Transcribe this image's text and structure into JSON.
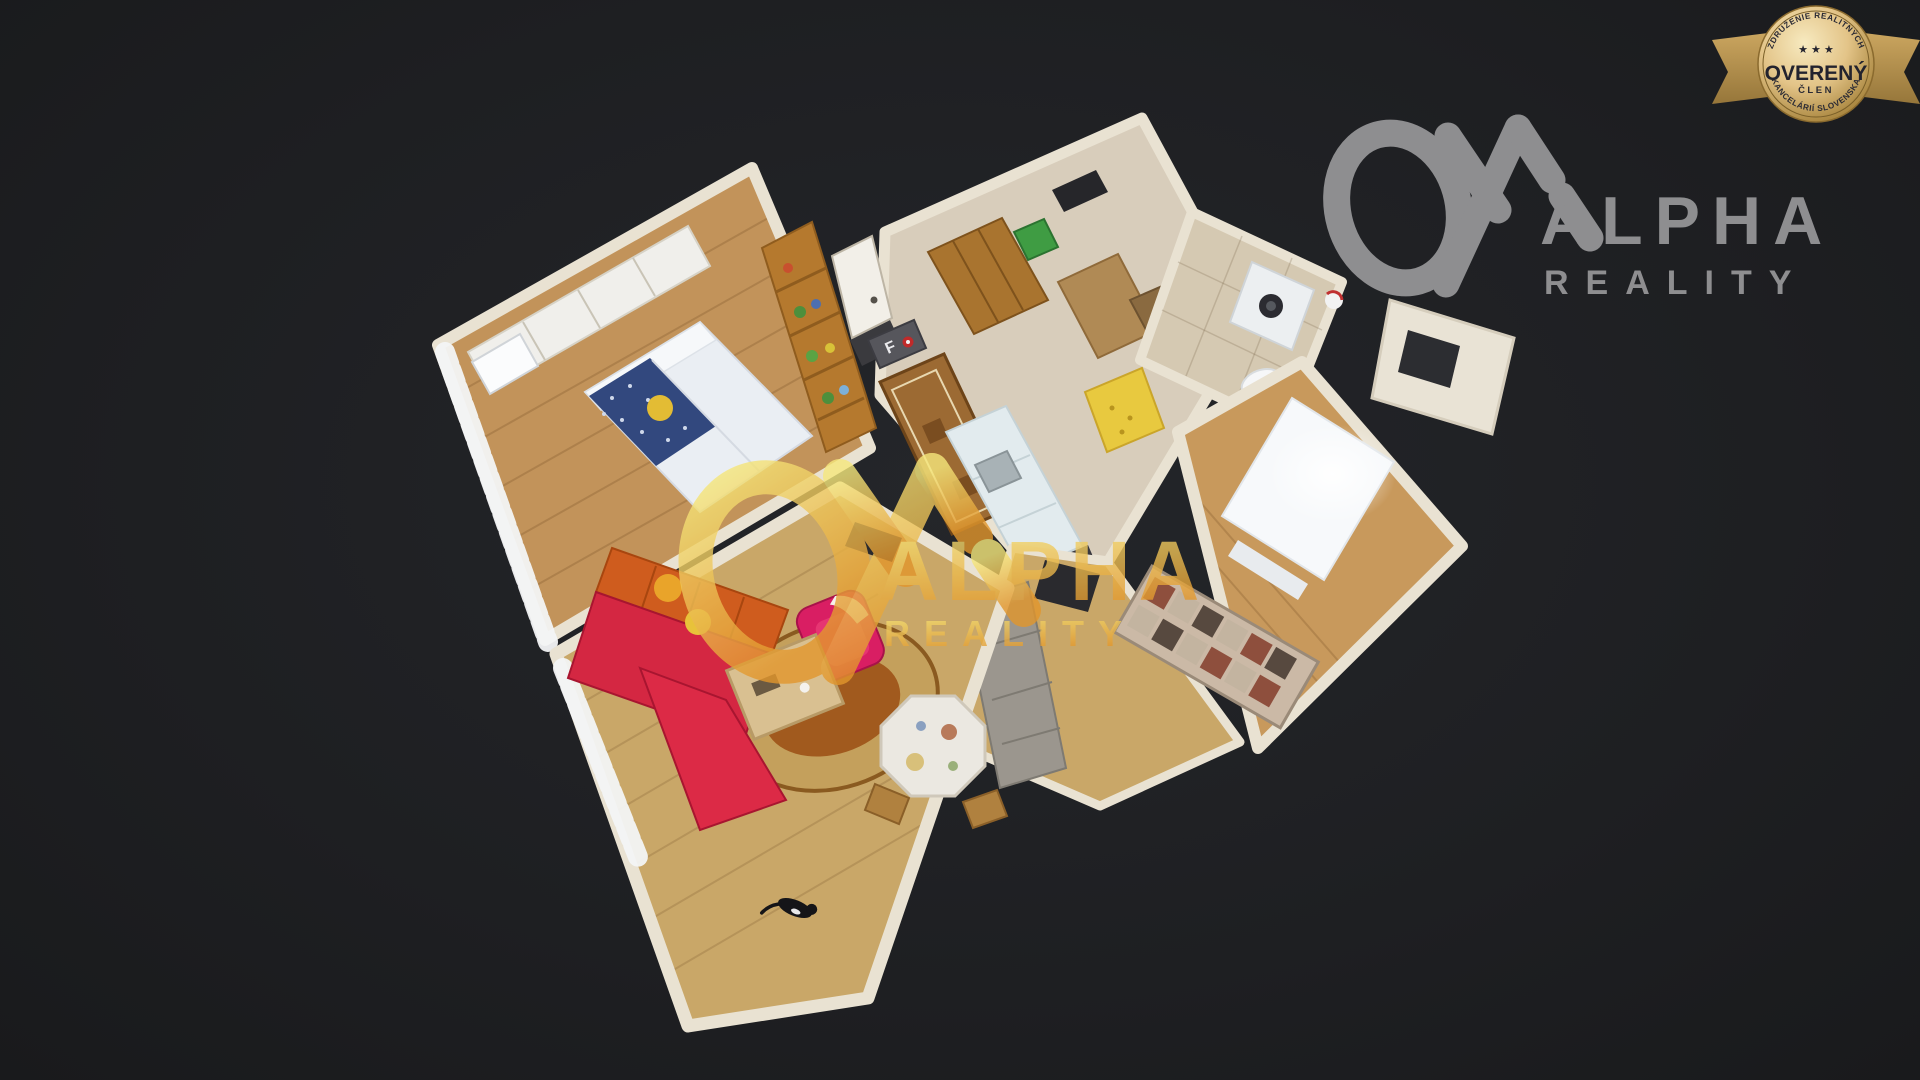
{
  "page": {
    "background": "#1f2023"
  },
  "badge": {
    "arc_top": "ZDRUŽENIE REALITNÝCH",
    "arc_bottom": "KANCELÁRIÍ SLOVENSKA",
    "stars": "★ ★ ★",
    "title": "OVERENÝ",
    "subtitle": "ČLEN",
    "gold_light": "#f7eac0",
    "gold_mid": "#e3c488",
    "gold_dark": "#a07c33",
    "ribbon_gold": "#bfa05e",
    "text_color": "#23232e"
  },
  "logo": {
    "brand": "ALPHA",
    "brand_sub": "REALITY",
    "color": "#8e8e90"
  },
  "watermark": {
    "brand": "ALPHA",
    "brand_sub": "REALITY",
    "gold_light": "#f6e87c",
    "gold_dark": "#e2962c",
    "opacity": "0.8"
  },
  "scene": {
    "doormat_label": "F",
    "colors": {
      "floor_wood": "#c2935a",
      "floor_wood_light": "#c9a768",
      "floor_tile": "#d8cdbb",
      "wall": "#e9e2d2",
      "curtain": "#f3f4f6",
      "bed_duvet": "#eaeef3",
      "blanket_blue": "#32487e",
      "pillow_yellow": "#e3bc34",
      "wardrobe_white": "#f0efeb",
      "wardrobe_wood": "#a9742f",
      "shelf_wood": "#b5792e",
      "runner_rug": "#9c6a33",
      "kitchen_counter": "#e2ebee",
      "yellow_table": "#e8c93f",
      "bath_tile": "#d5c9b2",
      "appliance_white": "#eceff1",
      "bin_green": "#3f9c43",
      "sofa_red": "#d42742",
      "sofa_orange": "#cf5c1e",
      "pillow_orange": "#e9a42a",
      "armchair_pink": "#d91e63",
      "coffee_table": "#d9c091",
      "rug_outer": "#c4a05c",
      "rug_inner": "#a15a1e",
      "dining_cloth": "#ebe8e1",
      "rug_gray": "#9b968e",
      "daybed_base": "#cbb9a6",
      "daybed_patch_red": "#8e4f3d",
      "daybed_patch_dark": "#57493f",
      "cat_black": "#151518"
    }
  }
}
